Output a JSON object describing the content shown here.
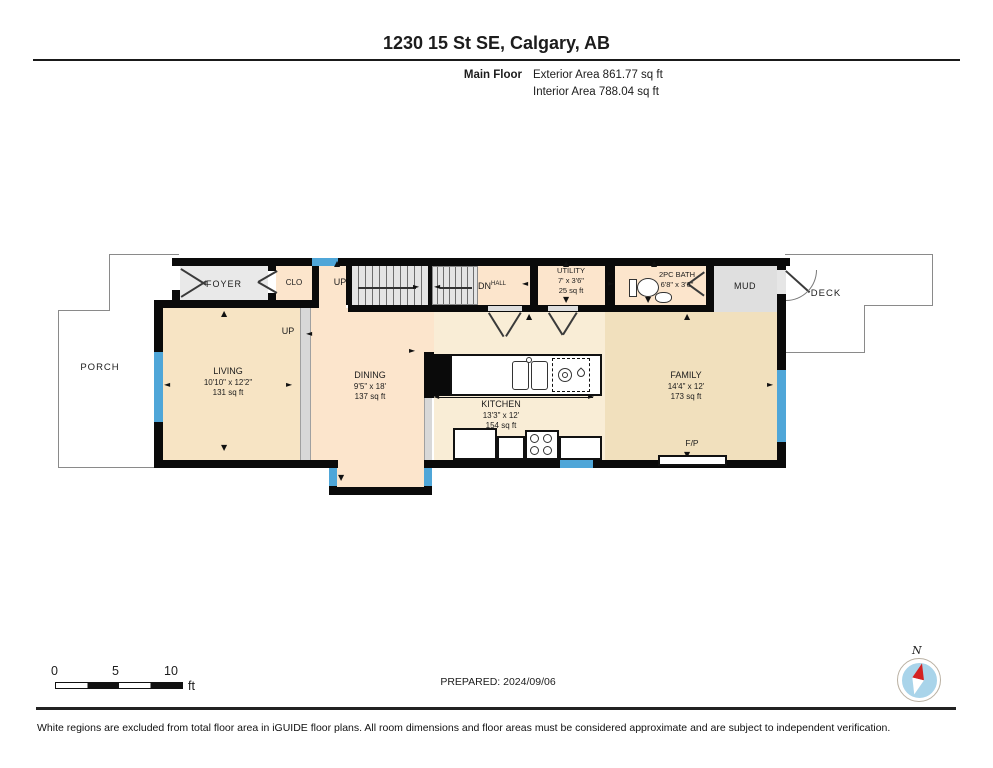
{
  "header": {
    "title": "1230 15 St SE, Calgary, AB",
    "floor_label": "Main Floor",
    "exterior_area": "Exterior Area 861.77 sq ft",
    "interior_area": "Interior Area 788.04 sq ft"
  },
  "plan": {
    "rooms": {
      "foyer": {
        "name": "FOYER"
      },
      "closet": {
        "name": "CLO"
      },
      "utility": {
        "name": "UTILITY",
        "dim": "7' x 3'6\"",
        "area": "25 sq ft"
      },
      "bath": {
        "name": "2PC BATH",
        "dim": "6'8\" x 3'6\""
      },
      "mud": {
        "name": "MUD"
      },
      "deck": {
        "name": "DECK"
      },
      "porch": {
        "name": "PORCH"
      },
      "living": {
        "name": "LIVING",
        "dim": "10'10\" x 12'2\"",
        "area": "131 sq ft"
      },
      "dining": {
        "name": "DINING",
        "dim": "9'5\" x 18'",
        "area": "137 sq ft"
      },
      "kitchen": {
        "name": "KITCHEN",
        "dim": "13'3\" x 12'",
        "area": "154 sq ft"
      },
      "family": {
        "name": "FAMILY",
        "dim": "14'4\" x 12'",
        "area": "173 sq ft"
      }
    },
    "stairs": {
      "up_label": "UP",
      "up_label_2": "UP",
      "dn_label": "DN",
      "hall_label": "HALL"
    },
    "fireplace_label": "F/P"
  },
  "glyphs": {
    "up": "▲",
    "down": "▼",
    "left": "◄",
    "right": "►"
  },
  "scale_bar": {
    "tick_0": "0",
    "tick_5": "5",
    "tick_10": "10",
    "unit": "ft"
  },
  "compass": {
    "north_label": "N"
  },
  "footer": {
    "prepared": "PREPARED: 2024/09/06",
    "disclaimer": "White regions are excluded from total floor area in iGUIDE floor plans. All room dimensions and floor areas must be considered approximate and are subject to independent verification."
  },
  "colors": {
    "wall": "#0a0a0a",
    "window": "#4fa6d8",
    "floor_tan": "#f7e4c4",
    "floor_peach": "#fce5cc",
    "floor_kitchen": "#f9edd6",
    "floor_family": "#f1e0bd",
    "room_gray": "#e9e9e9",
    "compass_blue": "#a9d4ea",
    "compass_red": "#d42222"
  }
}
